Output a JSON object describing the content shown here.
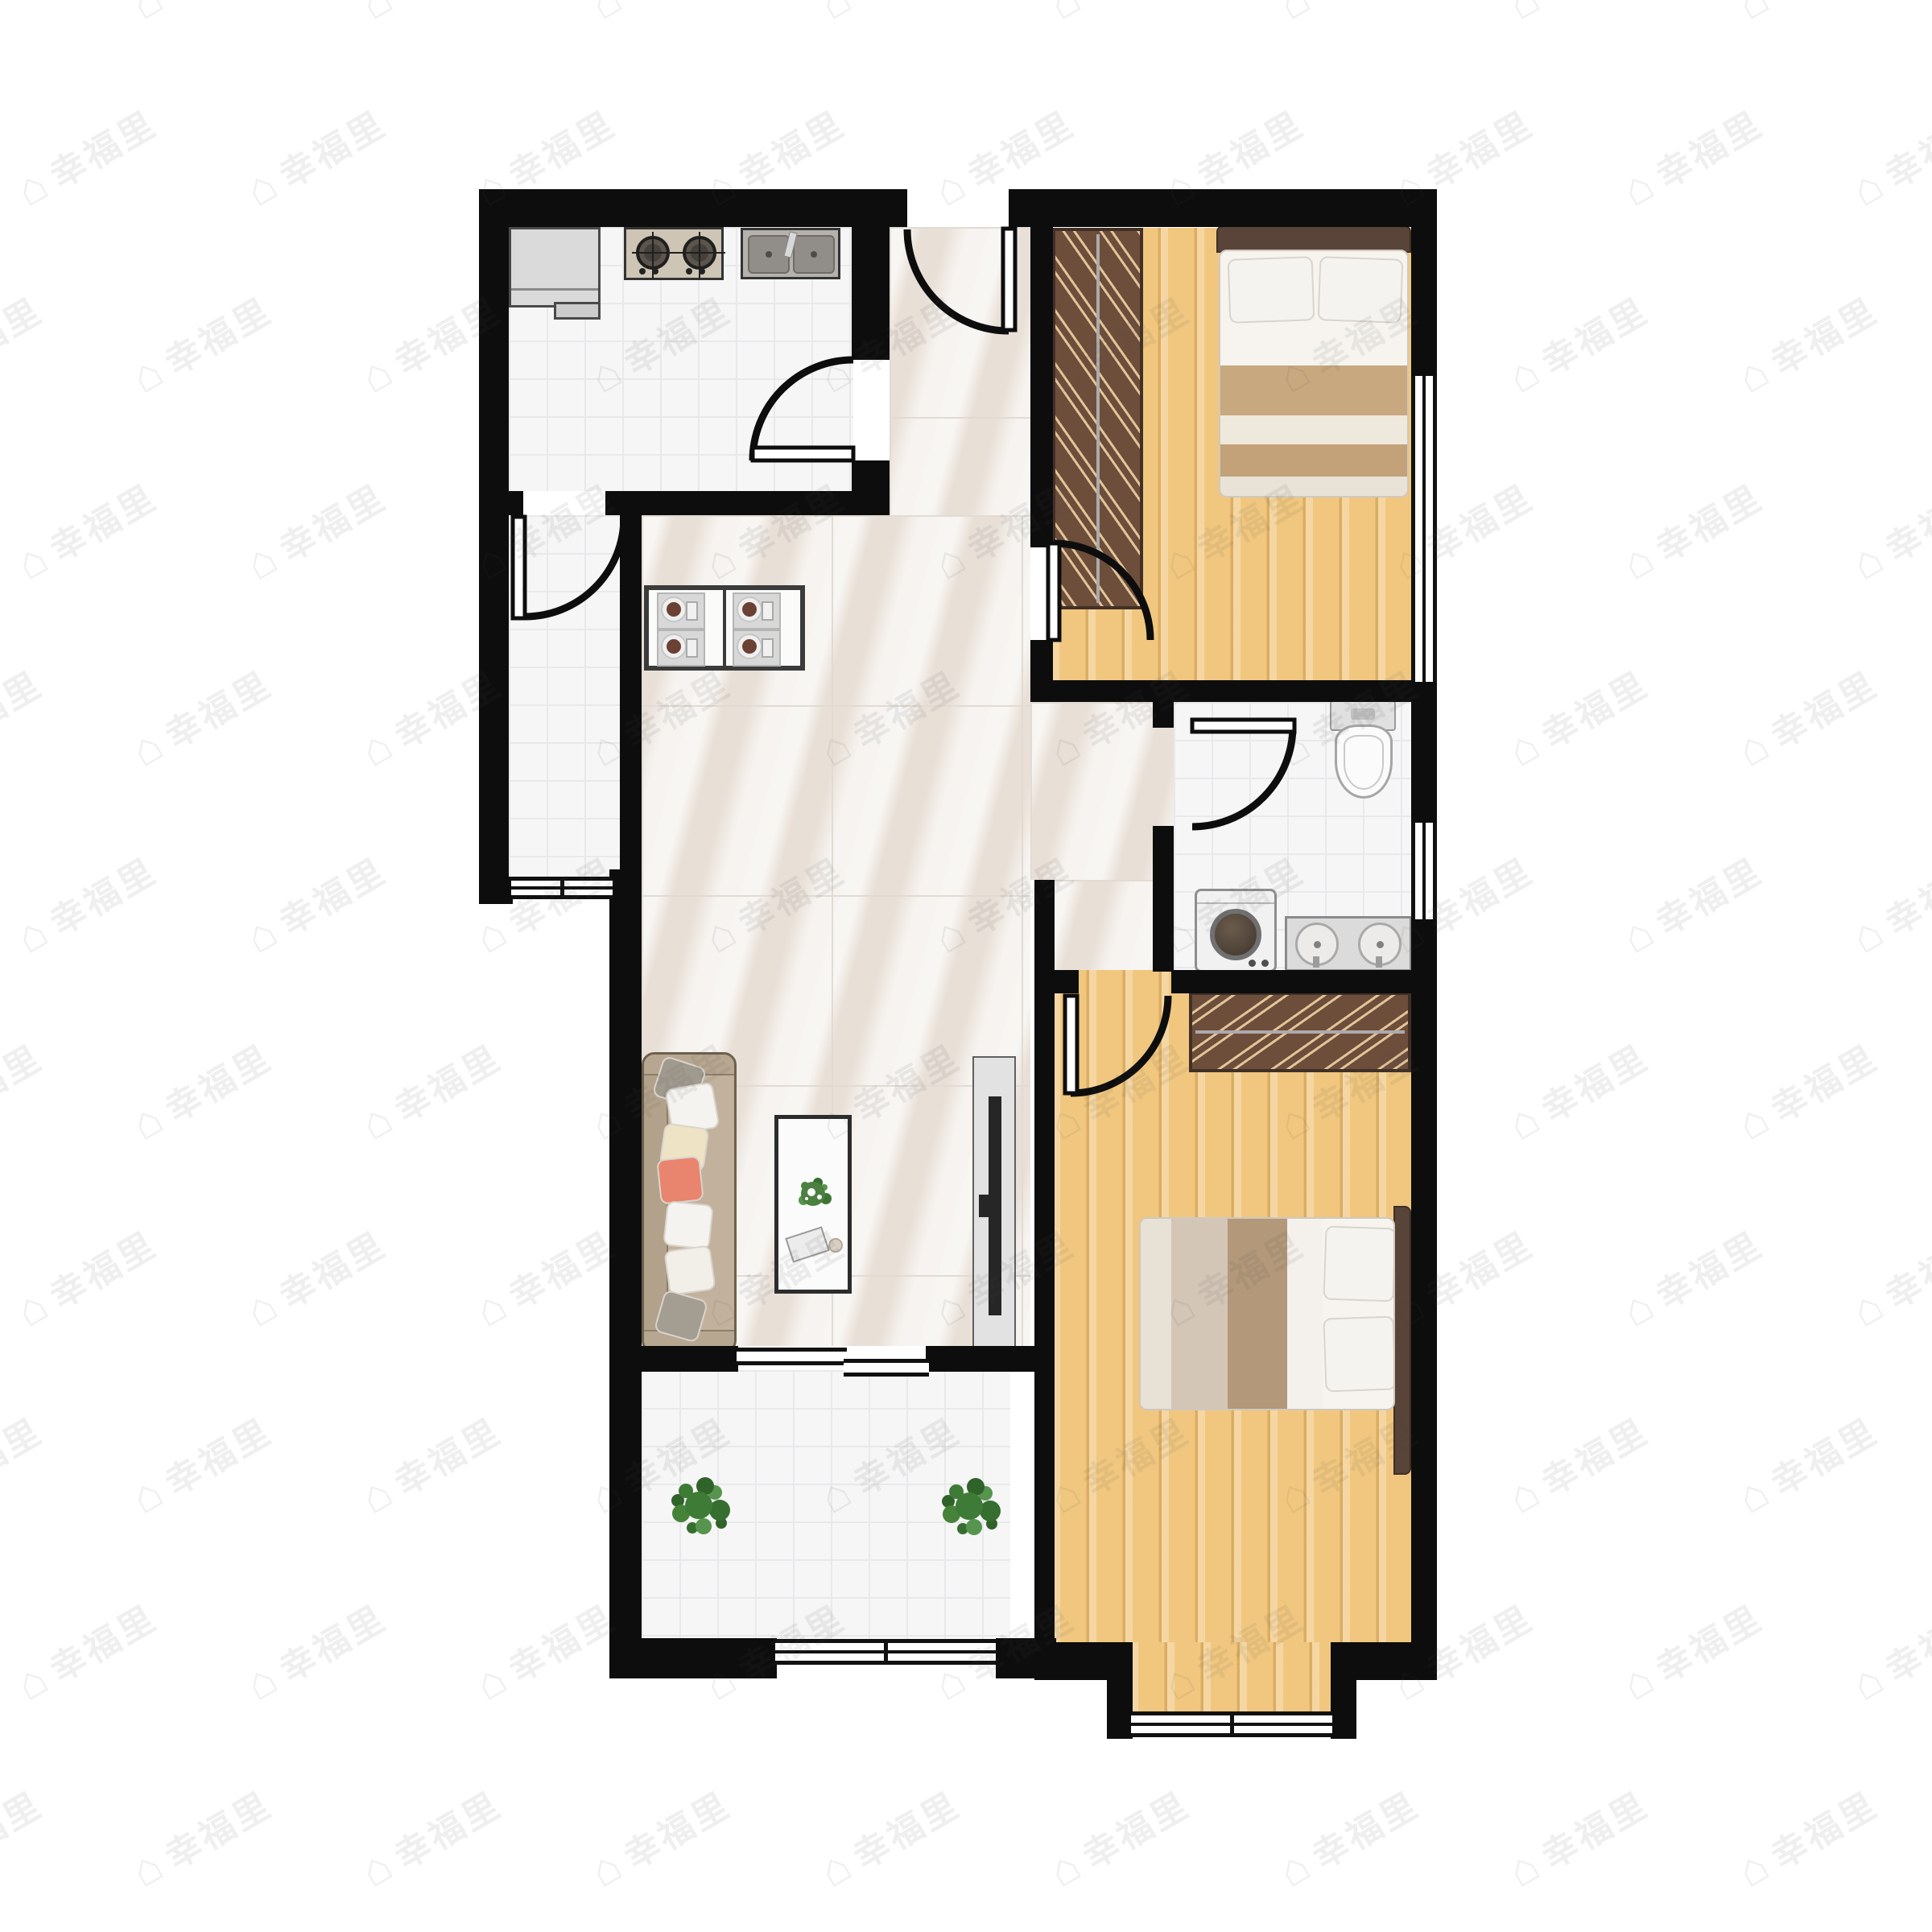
{
  "watermark": {
    "text": "幸福里",
    "icon": "house-icon",
    "color": "rgba(80,80,80,0.09)",
    "rotation_deg": -30
  },
  "palette": {
    "wall": "#0d0d0d",
    "tile_floor": "#f6f6f7",
    "tile_grid": "#e9e9eb",
    "marble_floor": "#efeae4",
    "wood_floor": "#f1c77f",
    "wardrobe_brown": "#6d4e3b",
    "headboard_brown": "#584438",
    "bed_stripe_tan": "#c8a87f",
    "bed_stripe_cream": "#efe8dd",
    "sofa_body": "#c2b29d",
    "pillow_coral": "#e9846e",
    "plant_green": "#3e7b36",
    "appliance_panel": "#cec5b5",
    "counter_gray": "#dbdbdb"
  },
  "plan": {
    "rooms": [
      {
        "name": "kitchen",
        "floor": "white-tile",
        "furniture": [
          "refrigerator",
          "gas-stove",
          "double-sink"
        ]
      },
      {
        "name": "storage-room",
        "floor": "white-tile",
        "furniture": []
      },
      {
        "name": "entry-hall",
        "floor": "marble-tile",
        "furniture": []
      },
      {
        "name": "dining-area",
        "floor": "marble-tile",
        "furniture": [
          "dining-table",
          "chair",
          "chair",
          "chair",
          "chair"
        ]
      },
      {
        "name": "living-area",
        "floor": "marble-tile",
        "furniture": [
          "sofa",
          "coffee-table",
          "tv-cabinet"
        ]
      },
      {
        "name": "bedroom-north",
        "floor": "wood",
        "furniture": [
          "wardrobe",
          "double-bed"
        ]
      },
      {
        "name": "bathroom",
        "floor": "white-tile",
        "furniture": [
          "toilet",
          "washing-machine",
          "double-vanity"
        ]
      },
      {
        "name": "bedroom-south",
        "floor": "wood",
        "furniture": [
          "wardrobe",
          "double-bed",
          "nightstand",
          "nightstand"
        ]
      },
      {
        "name": "balcony",
        "floor": "white-tile",
        "furniture": [
          "plant",
          "plant"
        ]
      }
    ],
    "doors": [
      "entrance",
      "kitchen",
      "storage-room",
      "bedroom-north",
      "bathroom",
      "bedroom-south"
    ],
    "windows": [
      "bedroom-north-east",
      "bathroom-east",
      "storage-south",
      "balcony-south",
      "bedroom-south-bay"
    ]
  }
}
